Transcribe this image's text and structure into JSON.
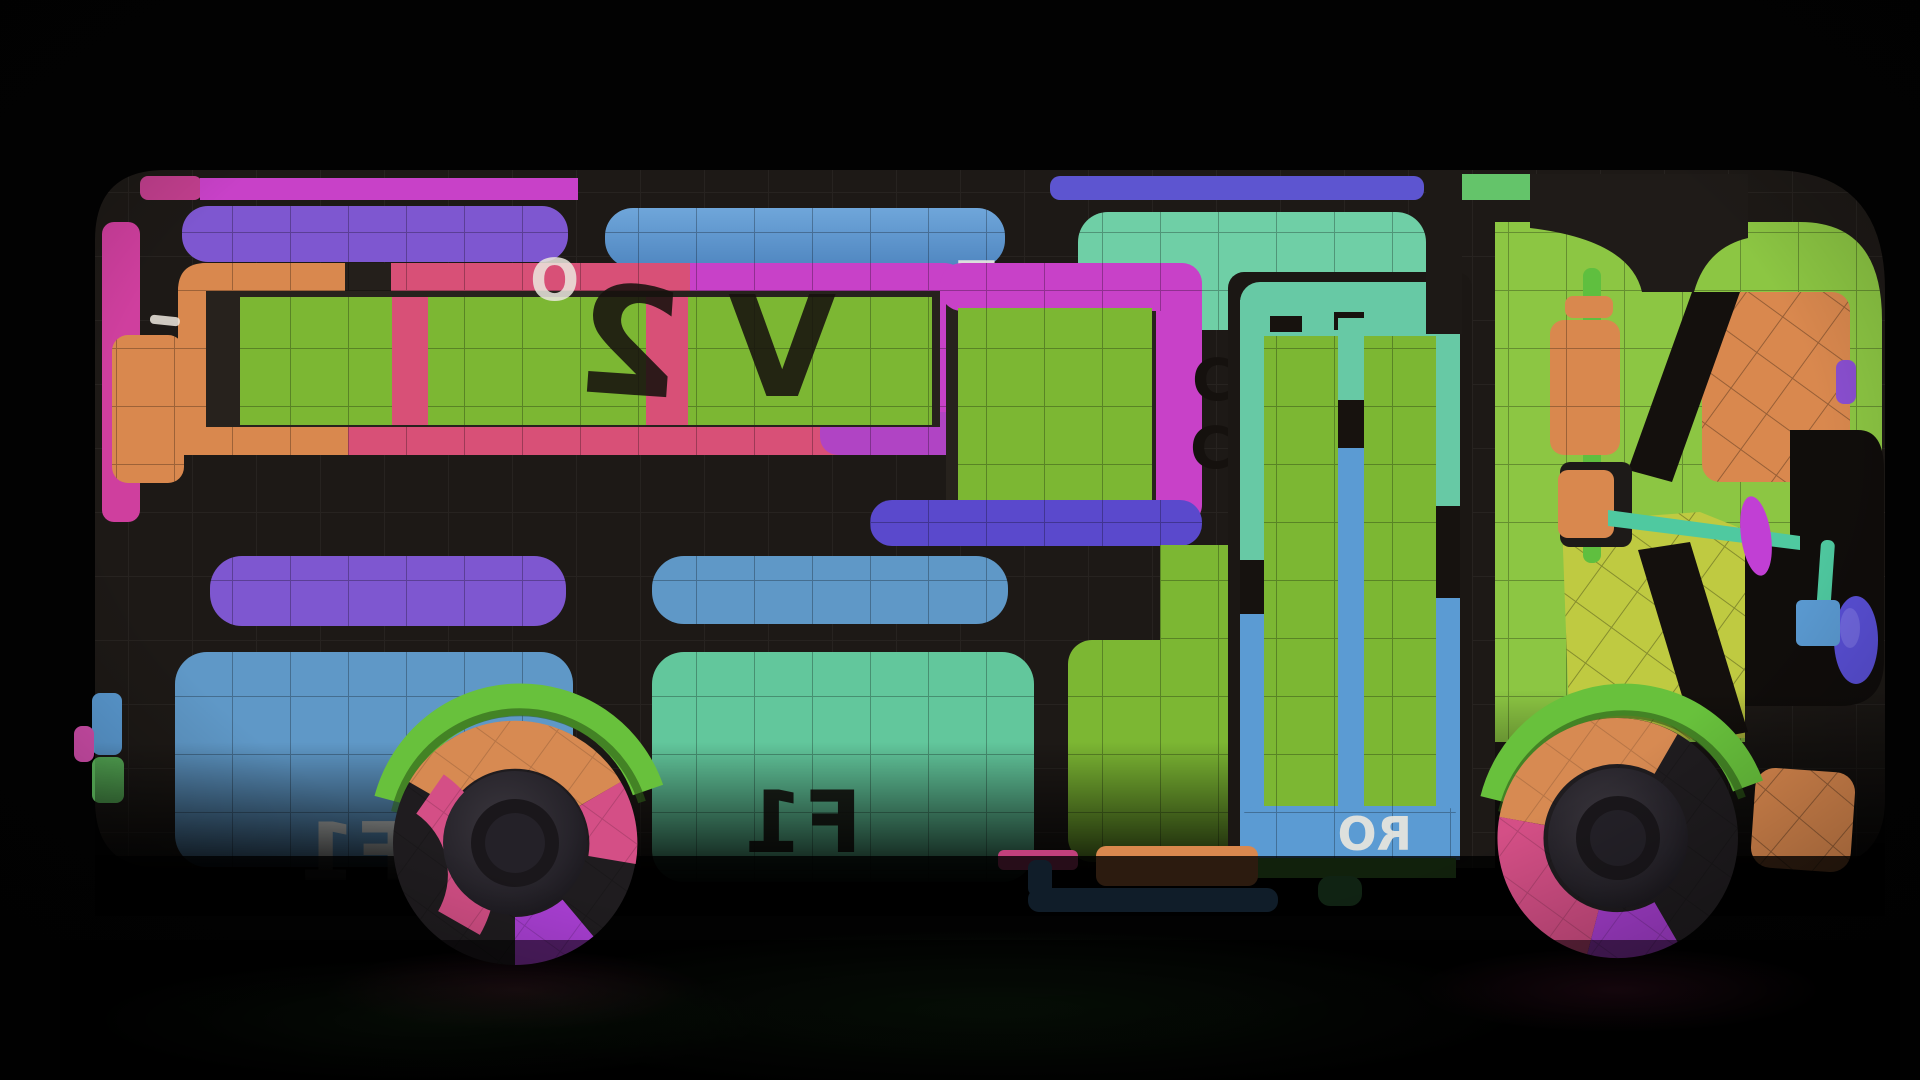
{
  "scene": {
    "description": "3D rendered side view of a toy school bus wrapped in a colorful UV-checker test texture, on a black studio background with a faint floor reflection",
    "object": "school-bus 3D model",
    "texture_style": "UV grid checker with mirrored letter markers",
    "view": "left side profile",
    "background": "black"
  },
  "glyphs": {
    "window_letter_2": "2",
    "window_letter_v": "V",
    "frame_letter_o": "O",
    "frame_letter_t": "T",
    "seam_letter_c_upper": "C",
    "seam_letter_c_lower": "C",
    "panel_label_f1": "F1",
    "panel_label_f1_white": "F1",
    "door_label_ro": "RO"
  },
  "palette": {
    "background": "#000000",
    "body_dark": "#1d1916",
    "pane_green": "#7cb733",
    "cab_green": "#8cc643",
    "frame_pink": "#d85077",
    "frame_magenta": "#c841c8",
    "frame_orange": "#d9884e",
    "band_purple": "#7e57d0",
    "bar_indigo": "#5a49cc",
    "panel_blue": "#5f98c7",
    "panel_teal": "#62c79c",
    "door_teal": "#67c9a5",
    "door_blue": "#5b9bd3",
    "hood_yellow": "#bfca41",
    "wheel_pink": "#d44f86",
    "wheel_purple": "#a93fd3",
    "wheel_orange": "#d78a52",
    "fender_green": "#68c13c",
    "mirror_magenta": "#c13fd4",
    "headlight_violet": "#5a50d8"
  }
}
